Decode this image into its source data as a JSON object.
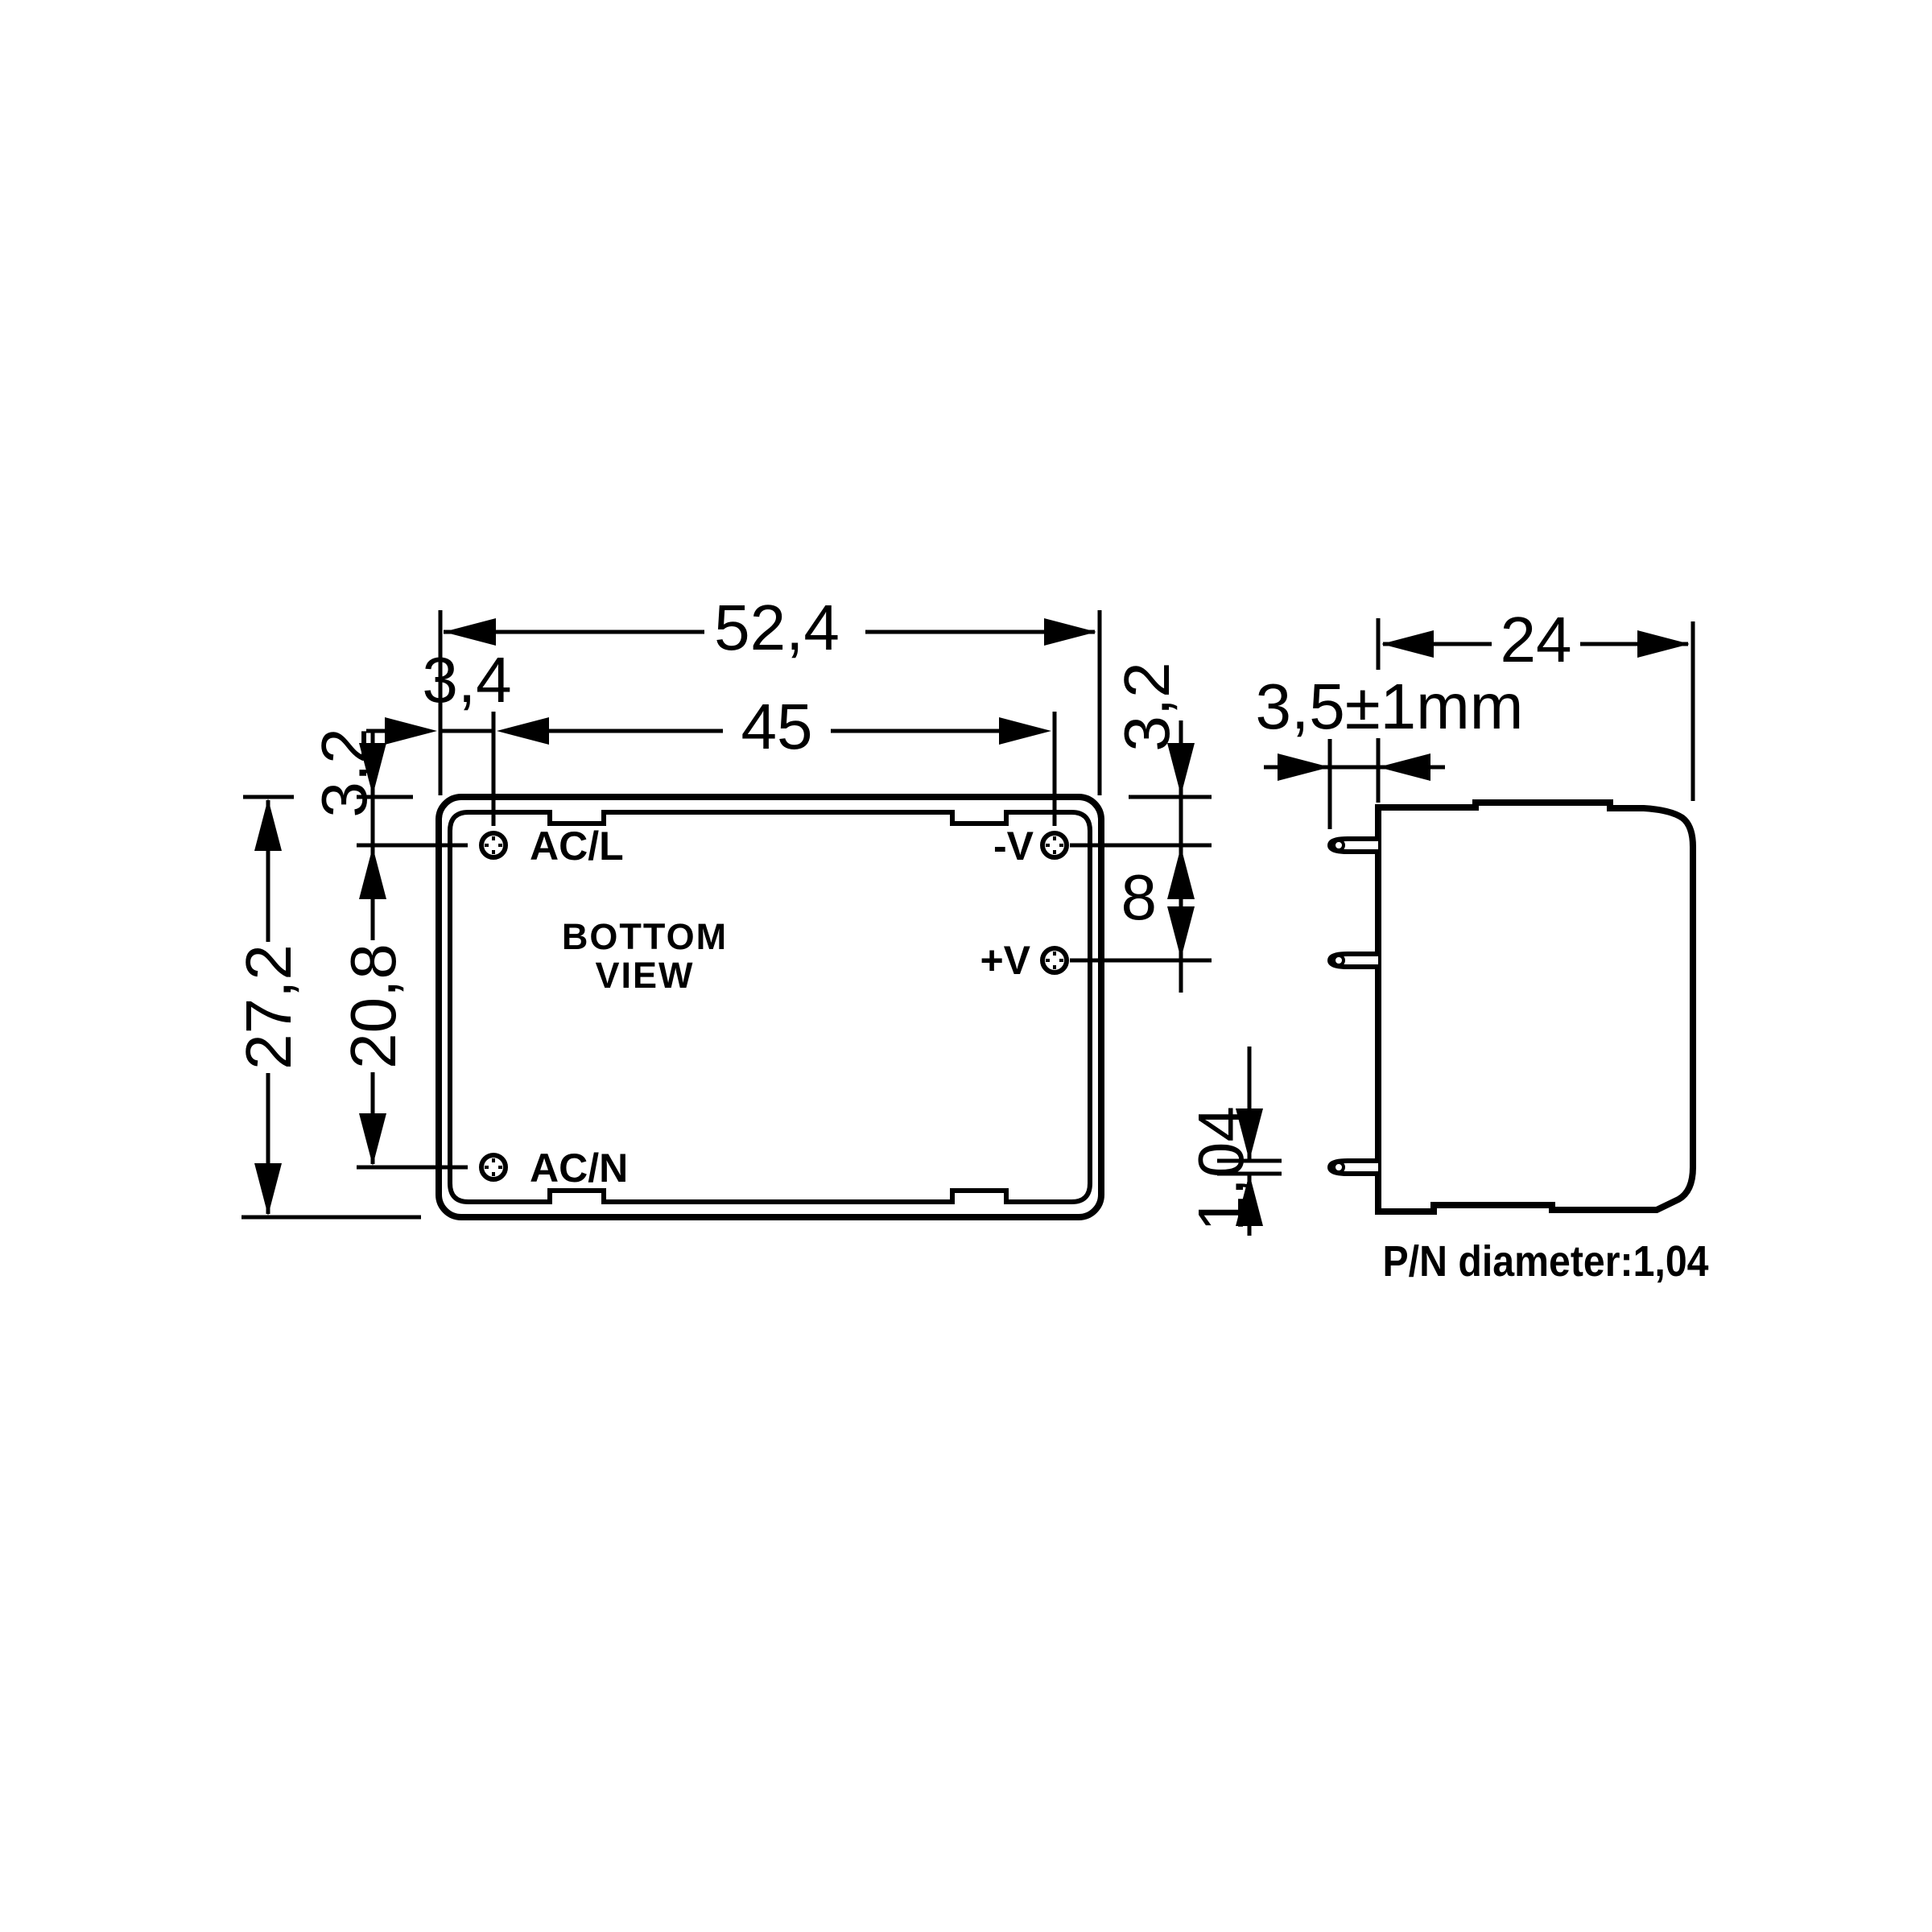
{
  "drawing": {
    "type": "mechanical-dimension-drawing",
    "background_color": "#ffffff",
    "line_color": "#000000",
    "bottom_view": {
      "caption": {
        "line1": "BOTTOM",
        "line2": "VIEW"
      },
      "pin_labels": {
        "ac_l": "AC/L",
        "ac_n": "AC/N",
        "v_minus": "-V",
        "v_plus": "+V"
      },
      "dims": {
        "total_width": "52,4",
        "pin_offset_left": "3,4",
        "pin_span_x": "45",
        "top_to_pin_left": "3,2",
        "total_height": "27,2",
        "pin_span_y": "20,8",
        "top_to_pin_right": "3,2",
        "output_pin_pitch": "8"
      }
    },
    "side_view": {
      "dims": {
        "depth": "24",
        "pin_length": "3,5±1mm",
        "pin_diameter": "1,04"
      },
      "note": "P/N diameter:1,04"
    }
  }
}
